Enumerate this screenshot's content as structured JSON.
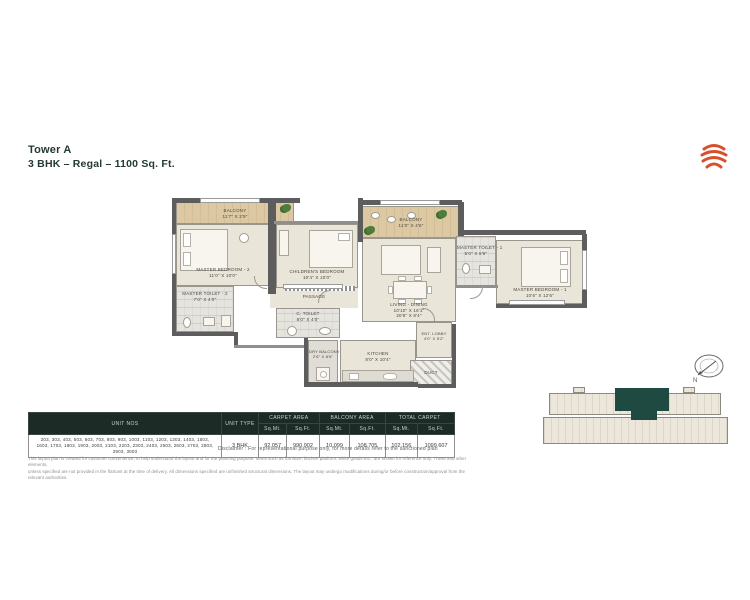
{
  "header": {
    "tower": "Tower A",
    "subtitle": "3 BHK – Regal – 1100 Sq. Ft."
  },
  "floorplan": {
    "rooms": [
      {
        "name": "BALCONY",
        "dim": "11'7\" X 2'9\""
      },
      {
        "name": "MASTER BEDROOM - 2",
        "dim": "11'0\" X 10'0\""
      },
      {
        "name": "MASTER TOILET - 2",
        "dim": "7'0\" X 4'0\""
      },
      {
        "name": "CHILDREN'S BEDROOM",
        "dim": "10'4\" X 10'0\""
      },
      {
        "name": "PASSAGE"
      },
      {
        "name": "C. TOILET",
        "dim": "8'0\" X 4'0\""
      },
      {
        "name": "BALCONY",
        "dim": "11'0\" X 4'6\""
      },
      {
        "name": "LIVING - DINING",
        "dim": "10'10\" X 16'1\"",
        "dim2": "20'6\" X 8'4\""
      },
      {
        "name": "MASTER TOILET - 1",
        "dim": "5'0\" X 8'6\""
      },
      {
        "name": "MASTER BEDROOM - 1",
        "dim": "10'6\" X 12'6\""
      },
      {
        "name": "DRY BALCONY",
        "dim": "2'6\" X 8'6\""
      },
      {
        "name": "KITCHEN",
        "dim": "8'0\" X 10'4\""
      },
      {
        "name": "ENT. LOBBY",
        "dim": "4'0\" X 5'2\""
      },
      {
        "name": "DUCT"
      }
    ]
  },
  "table": {
    "col_unit_nos": "UNIT NOS",
    "col_unit_type": "UNIT TYPE",
    "col_carpet": "CARPET AREA",
    "col_balcony": "BALCONY AREA",
    "col_total": "TOTAL CARPET",
    "sub_mt": "Sq.Mt.",
    "sub_ft": "Sq.Ft.",
    "row": {
      "unit_nos_line1": "203, 303, 403, 503, 603, 703, 803, 903, 1003, 1103, 1203, 1303, 1403, 1503,",
      "unit_nos_line2": "1603, 1703, 1803, 1903, 2003, 2103, 2203, 2303, 2403, 2503, 2603, 2703, 2803, 2903, 3003",
      "unit_type": "3 BHK",
      "carpet_sqmt": "92.057",
      "carpet_sqft": "990.902",
      "balcony_sqmt": "10.099",
      "balcony_sqft": "108.705",
      "total_sqmt": "102.156",
      "total_sqft": "1099.607"
    }
  },
  "disclaimer": "Disclaimer : For representational purpose only, for more details refer to the sanctioned plan",
  "fine_print": {
    "line1": "This layout plan is created for customer convenience, to help understand the layout and for the planning purpose. Items such as furniture, kitchen platform, white goods etc., are shown for reference only. These and other elements,",
    "line2": "unless specified are not provided in the flat/unit at the time of delivery. All dimensions specified are unfinished structural dimensions. The layout may undergo modifications during/or before construction/approval from the relevant authorities."
  },
  "keyplan": {
    "north_label": "N"
  },
  "colors": {
    "accent_logo": "#D8502B",
    "table_header": "#1C2B26",
    "highlight_unit": "#1E4A42",
    "walls": "#5D5D5D",
    "wood_floor": "#D9C6A0",
    "floor": "#EAE5D9"
  }
}
